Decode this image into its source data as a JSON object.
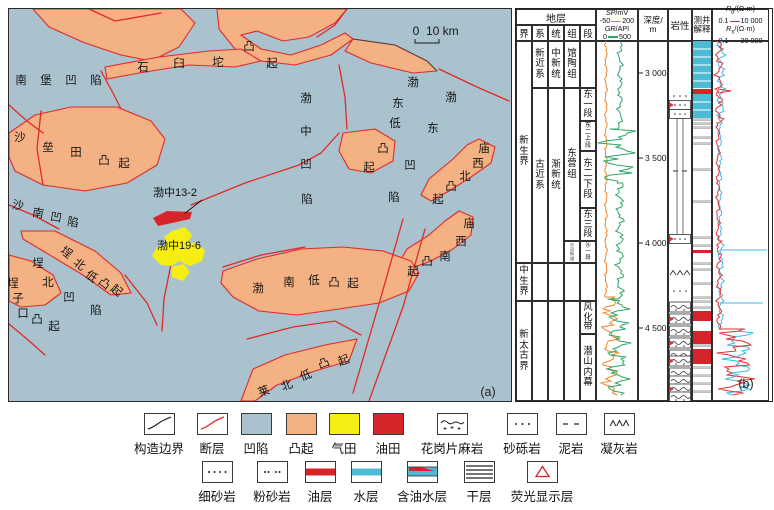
{
  "figure": {
    "panel_a_label": "(a)",
    "panel_b_label": "(b)"
  },
  "colors": {
    "sea": "#a9c2cd",
    "uplift": "#f4b183",
    "fault": "#e02a2a",
    "gas": "#f6ee12",
    "oil": "#d6252a",
    "water": "#4cbcd4",
    "gr": "#2fa566",
    "sp": "#f0862a",
    "rd": "#e03131",
    "rs": "#42b9e5"
  },
  "map": {
    "scale_bar": {
      "zero": "0",
      "ten": "10 km"
    },
    "oil_field_label": "渤中13-2",
    "gas_field_label": "渤中19-6",
    "char_labels": [
      {
        "text": "南堡凹陷",
        "rot": 0,
        "pts": [
          [
            12,
            72
          ],
          [
            37,
            72
          ],
          [
            62,
            72
          ],
          [
            87,
            72
          ]
        ]
      },
      {
        "text": "石臼坨凸起",
        "rot": 0,
        "pts": [
          [
            134,
            59
          ],
          [
            170,
            55
          ],
          [
            209,
            54
          ],
          [
            240,
            38
          ],
          [
            263,
            55
          ]
        ]
      },
      {
        "text": "沙垒田凸起",
        "rot": 0,
        "pts": [
          [
            11,
            129
          ],
          [
            39,
            139
          ],
          [
            67,
            144
          ],
          [
            95,
            152
          ],
          [
            115,
            155
          ]
        ]
      },
      {
        "text": "沙南凹陷",
        "rot": 10,
        "pts": [
          [
            9,
            197
          ],
          [
            29,
            205
          ],
          [
            47,
            209
          ],
          [
            64,
            214
          ]
        ]
      },
      {
        "text": "渤中凹陷",
        "rot": 0,
        "pts": [
          [
            297,
            90
          ],
          [
            297,
            123
          ],
          [
            297,
            156
          ],
          [
            298,
            191
          ]
        ]
      },
      {
        "text": "渤东低凸起",
        "rot": 0,
        "pts": [
          [
            404,
            74
          ],
          [
            389,
            95
          ],
          [
            386,
            115
          ],
          [
            374,
            140
          ],
          [
            360,
            159
          ]
        ]
      },
      {
        "text": "渤东凹陷",
        "rot": 0,
        "pts": [
          [
            442,
            89
          ],
          [
            424,
            120
          ],
          [
            401,
            157
          ],
          [
            385,
            189
          ]
        ]
      },
      {
        "text": "庙西北凸起",
        "rot": 0,
        "pts": [
          [
            475,
            140
          ],
          [
            469,
            155
          ],
          [
            456,
            168
          ],
          [
            442,
            178
          ],
          [
            429,
            191
          ]
        ]
      },
      {
        "text": "庙西南凸起",
        "rot": 0,
        "pts": [
          [
            460,
            215
          ],
          [
            452,
            233
          ],
          [
            436,
            248
          ],
          [
            418,
            253
          ],
          [
            404,
            263
          ]
        ]
      },
      {
        "text": "渤南低凸起",
        "rot": 0,
        "pts": [
          [
            249,
            280
          ],
          [
            280,
            274
          ],
          [
            305,
            272
          ],
          [
            325,
            274
          ],
          [
            344,
            275
          ]
        ]
      },
      {
        "text": "埕北凹陷",
        "rot": 0,
        "pts": [
          [
            29,
            255
          ],
          [
            39,
            274
          ],
          [
            60,
            289
          ],
          [
            87,
            302
          ]
        ]
      },
      {
        "text": "埕北低凸起",
        "rot": 38,
        "pts": [
          [
            57,
            244
          ],
          [
            70,
            256
          ],
          [
            82,
            268
          ],
          [
            95,
            275
          ],
          [
            107,
            282
          ]
        ]
      },
      {
        "text": "埕子口凸起",
        "rot": 0,
        "pts": [
          [
            4,
            275
          ],
          [
            9,
            290
          ],
          [
            14,
            305
          ],
          [
            28,
            311
          ],
          [
            45,
            318
          ]
        ]
      },
      {
        "text": "莱北低凸起",
        "rot": -20,
        "pts": [
          [
            255,
            383
          ],
          [
            278,
            377
          ],
          [
            297,
            367
          ],
          [
            315,
            355
          ],
          [
            335,
            352
          ]
        ]
      }
    ],
    "text_labels": [
      {
        "text": "渤中13-2",
        "x": 166,
        "y": 187
      },
      {
        "text": "渤中19-6",
        "x": 170,
        "y": 240
      }
    ]
  },
  "log": {
    "headers": {
      "strat": "地层",
      "cols": [
        "界",
        "系",
        "统",
        "组",
        "段"
      ],
      "sp_sym": "SP",
      "sp_unit": "/mV",
      "sp_min": "-50",
      "sp_max": "200",
      "gr_sym": "GR",
      "gr_unit": "/API",
      "gr_min": "0",
      "gr_max": "500",
      "depth": "深度/",
      "depth_unit": "m",
      "lith": "岩性",
      "interp_l1": "测井",
      "interp_l2": "解释",
      "r_sym": "R",
      "rd_sub": "d",
      "rs_sub": "s",
      "r_unit": "/(Ω·m)",
      "rd_min": "0.1",
      "rd_max": "10 000",
      "rs_min": "0.1",
      "rs_max": "20 000"
    },
    "era": [
      {
        "label": "新生界",
        "y0": 32,
        "y1": 254
      },
      {
        "label": "中生界",
        "y0": 254,
        "y1": 292
      },
      {
        "label": "新太古界",
        "y0": 292,
        "y1": 392
      }
    ],
    "system": [
      {
        "label": "新近系",
        "y0": 32,
        "y1": 79
      },
      {
        "label": "古近系",
        "y0": 79,
        "y1": 254
      },
      {
        "label": "",
        "y0": 254,
        "y1": 292
      },
      {
        "label": "",
        "y0": 292,
        "y1": 392
      }
    ],
    "series": [
      {
        "label": "中新统",
        "y0": 32,
        "y1": 79
      },
      {
        "label": "渐新统",
        "y0": 79,
        "y1": 254
      },
      {
        "label": "",
        "y0": 254,
        "y1": 292
      },
      {
        "label": "",
        "y0": 292,
        "y1": 392
      }
    ],
    "formation": [
      {
        "label": "馆陶组",
        "y0": 32,
        "y1": 79
      },
      {
        "label": "东营组",
        "y0": 79,
        "y1": 232
      },
      {
        "label": "沙河街组",
        "y0": 232,
        "y1": 254
      },
      {
        "label": "",
        "y0": 254,
        "y1": 292
      },
      {
        "label": "",
        "y0": 292,
        "y1": 392
      }
    ],
    "member": [
      {
        "label": "",
        "y0": 32,
        "y1": 79
      },
      {
        "label": "东一段",
        "y0": 79,
        "y1": 112
      },
      {
        "label": "东二上段",
        "y0": 112,
        "y1": 142
      },
      {
        "label": "东二下段",
        "y0": 142,
        "y1": 199
      },
      {
        "label": "东三段",
        "y0": 199,
        "y1": 232
      },
      {
        "label": "沙一段",
        "y0": 232,
        "y1": 254
      },
      {
        "label": "",
        "y0": 254,
        "y1": 292
      },
      {
        "label": "风化带",
        "y0": 292,
        "y1": 325
      },
      {
        "label": "潜山内幕",
        "y0": 325,
        "y1": 392
      }
    ],
    "depth_ticks": [
      {
        "label": "3 000",
        "y": 64
      },
      {
        "label": "3 500",
        "y": 149
      },
      {
        "label": "4 000",
        "y": 234
      },
      {
        "label": "4 500",
        "y": 319
      }
    ],
    "bands": [
      {
        "y0": 32,
        "y1": 79,
        "t": "water"
      },
      {
        "y0": 80,
        "y1": 85,
        "t": "oil"
      },
      {
        "y0": 85,
        "y1": 109,
        "t": "water"
      },
      {
        "y0": 241,
        "y1": 244,
        "t": "oil"
      },
      {
        "y0": 302,
        "y1": 312,
        "t": "oil"
      },
      {
        "y0": 322,
        "y1": 335,
        "t": "oil"
      },
      {
        "y0": 340,
        "y1": 355,
        "t": "oil"
      }
    ],
    "dry_lines": [
      110,
      114,
      118,
      128,
      134,
      160,
      192,
      228,
      236,
      254,
      260,
      274,
      288,
      292,
      298,
      336,
      358,
      366,
      374,
      382
    ],
    "lithology": [
      {
        "y": 87,
        "t": "dots",
        "fl": false
      },
      {
        "y": 96,
        "t": "sandbox",
        "fl": true
      },
      {
        "y": 105,
        "t": "sandbox",
        "fl": false
      },
      {
        "y": 162,
        "t": "dash",
        "fl": false
      },
      {
        "y": 230,
        "t": "sandbox",
        "fl": true
      },
      {
        "y": 264,
        "t": "tuff",
        "fl": false
      },
      {
        "y": 282,
        "t": "dots",
        "fl": false
      },
      {
        "y": 298,
        "t": "gneiss",
        "fl": false
      },
      {
        "y": 310,
        "t": "gneiss",
        "fl": true
      },
      {
        "y": 322,
        "t": "gneiss",
        "fl": false
      },
      {
        "y": 334,
        "t": "gneiss",
        "fl": true
      },
      {
        "y": 346,
        "t": "gneiss",
        "fl": false
      },
      {
        "y": 352,
        "t": "gneiss",
        "fl": true
      },
      {
        "y": 364,
        "t": "gneiss",
        "fl": false
      },
      {
        "y": 372,
        "t": "gneiss",
        "fl": false
      },
      {
        "y": 380,
        "t": "gneiss",
        "fl": true
      },
      {
        "y": 388,
        "t": "gneiss",
        "fl": false
      }
    ]
  },
  "legend": {
    "row1": [
      {
        "label": "构造边界",
        "swatch": "boundary"
      },
      {
        "label": "断层",
        "swatch": "fault"
      },
      {
        "label": "凹陷",
        "swatch": "fill-sea"
      },
      {
        "label": "凸起",
        "swatch": "fill-uplift"
      },
      {
        "label": "气田",
        "swatch": "fill-gas"
      },
      {
        "label": "油田",
        "swatch": "fill-oil"
      },
      {
        "label": "花岗片麻岩",
        "swatch": "gneiss"
      },
      {
        "label": "砂砾岩",
        "swatch": "dots3"
      },
      {
        "label": "泥岩",
        "swatch": "dashes"
      },
      {
        "label": "凝灰岩",
        "swatch": "carets"
      }
    ],
    "row2": [
      {
        "label": "细砂岩",
        "swatch": "dots4"
      },
      {
        "label": "粉砂岩",
        "swatch": "dots22"
      },
      {
        "label": "油层",
        "swatch": "oilband"
      },
      {
        "label": "水层",
        "swatch": "waterband"
      },
      {
        "label": "含油水层",
        "swatch": "oilwaterband"
      },
      {
        "label": "干层",
        "swatch": "dryband"
      },
      {
        "label": "荧光显示层",
        "swatch": "fluor"
      }
    ]
  }
}
